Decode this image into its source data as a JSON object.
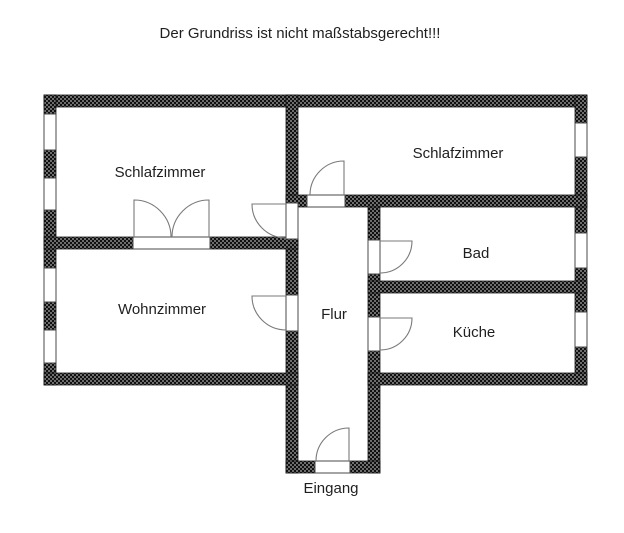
{
  "title": "Der Grundriss ist nicht maßstabsgerecht!!!",
  "rooms": {
    "schlafzimmer_left": {
      "label": "Schlafzimmer"
    },
    "schlafzimmer_right": {
      "label": "Schlafzimmer"
    },
    "wohnzimmer": {
      "label": "Wohnzimmer"
    },
    "bad": {
      "label": "Bad"
    },
    "kueche": {
      "label": "Küche"
    },
    "flur": {
      "label": "Flur"
    },
    "eingang": {
      "label": "Eingang"
    }
  },
  "colors": {
    "wall_dark": "#101010",
    "wall_light": "#6e6e6e",
    "text": "#1f1f1f",
    "background": "#ffffff"
  }
}
